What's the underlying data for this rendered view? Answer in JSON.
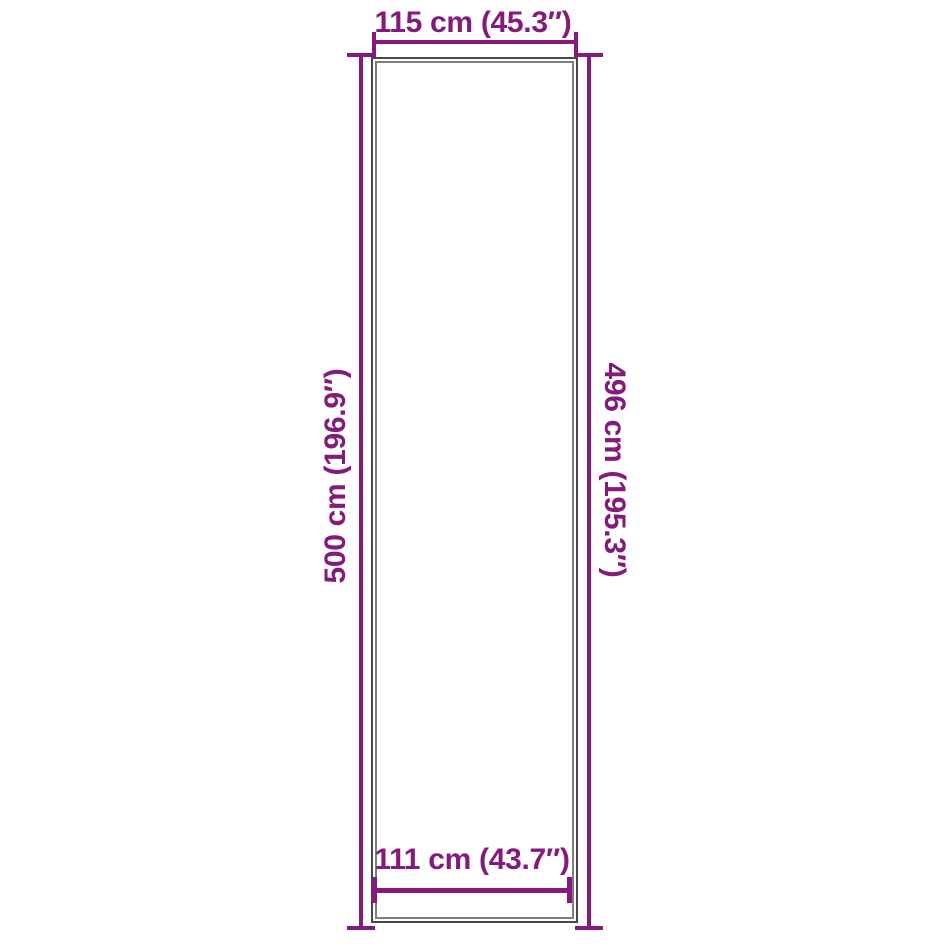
{
  "diagram": {
    "background_color": "#ffffff",
    "dimension_color": "#851A7B",
    "outline_outer_color": "#474747",
    "outline_inner_color": "#7d7d7d",
    "dimensions": {
      "top_width": {
        "label": "115 cm (45.3″)",
        "value_cm": 115,
        "value_in": 45.3
      },
      "left_height": {
        "label": "500 cm (196.9″)",
        "value_cm": 500,
        "value_in": 196.9
      },
      "right_height": {
        "label": "496 cm (195.3″)",
        "value_cm": 496,
        "value_in": 195.3
      },
      "bottom_inner_width": {
        "label": "111 cm (43.7″)",
        "value_cm": 111,
        "value_in": 43.7
      }
    }
  }
}
